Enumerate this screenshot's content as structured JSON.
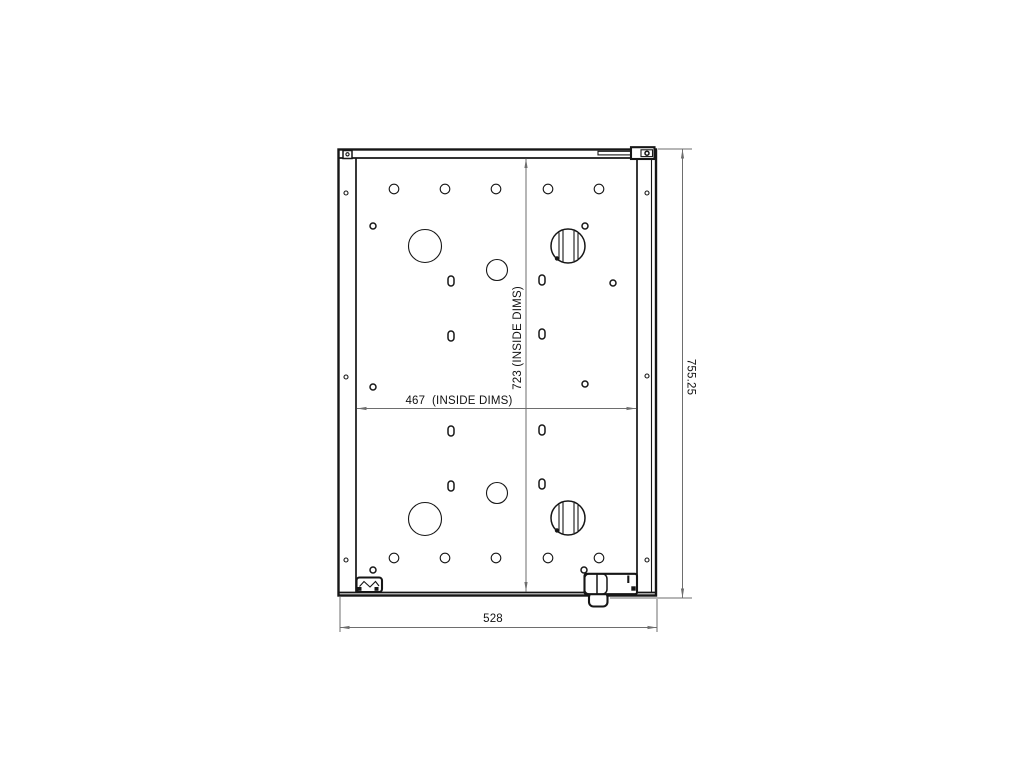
{
  "document": {
    "kind": "CAD technical drawing",
    "view": "enclosure back panel, front view"
  },
  "colors": {
    "background": "#ffffff",
    "outline": "#161616",
    "dimension_line": "#6e6e6e",
    "text": "#111111"
  },
  "labels": {
    "outside_width": "528",
    "outside_height": "755.25",
    "inside_width": "467  (INSIDE DIMS)",
    "inside_height": "723 (INSIDE DIMS)"
  },
  "features": {
    "mount_hole_rows": {
      "radius": 4.8,
      "rows_y": [
        189,
        558
      ],
      "cols_x": [
        394,
        445,
        496,
        548,
        599
      ]
    },
    "large_holes": {
      "radius": 16.5,
      "centers": [
        [
          425,
          246
        ],
        [
          425,
          519
        ]
      ]
    },
    "medium_holes": {
      "radius": 10.5,
      "centers": [
        [
          497,
          270
        ],
        [
          497,
          493
        ]
      ]
    },
    "grommet_holes": {
      "radius": 17,
      "centers": [
        [
          568,
          246
        ],
        [
          568,
          518
        ]
      ],
      "chord_offsets": [
        -9,
        -5,
        6,
        10
      ]
    },
    "slot_holes": {
      "w": 6,
      "h": 10,
      "centers": [
        [
          451,
          281
        ],
        [
          542,
          280
        ],
        [
          451,
          336
        ],
        [
          542,
          334
        ],
        [
          451,
          431
        ],
        [
          542,
          430
        ],
        [
          451,
          486
        ],
        [
          542,
          484
        ]
      ]
    },
    "pilot_holes": {
      "radius": 3,
      "centers": [
        [
          373,
          226
        ],
        [
          585,
          226
        ],
        [
          613,
          283
        ],
        [
          373,
          387
        ],
        [
          585,
          384
        ],
        [
          373,
          570
        ],
        [
          584,
          570
        ]
      ]
    },
    "flange_holes": {
      "radius": 2,
      "centers": [
        [
          346,
          193
        ],
        [
          346,
          377
        ],
        [
          346,
          560
        ],
        [
          647,
          193
        ],
        [
          647,
          376
        ],
        [
          647,
          560
        ]
      ]
    }
  }
}
